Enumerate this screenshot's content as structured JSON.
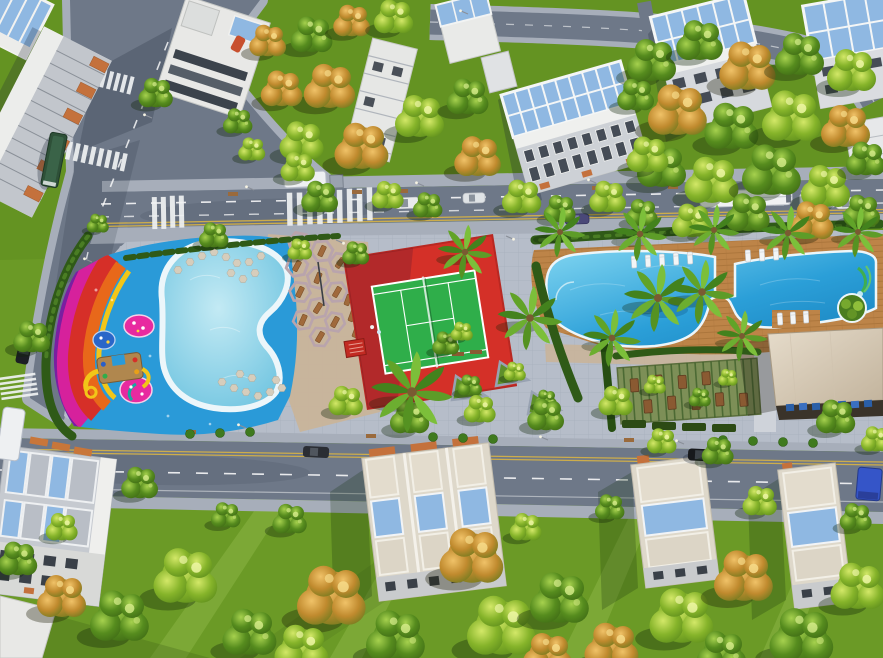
{
  "scene": {
    "description": "Aerial 3D architectural rendering of a residential community amenity strip at golden hour: a kids water playground with rainbow-striped deck and yellow slides, a kidney-shaped splash pool with stepping stones, hexagonal cabana seating, a red-apron tennis court with bright green surface, a large resort lagoon pool with timber deck, white sun loungers, palm islands and a green water slide, a beige clubhouse roof, a bamboo pergola terrace, tree-lined avenues with buses and cars, and white apartment buildings and townhouses with blue glass roofs among dense green and autumn-gold trees.",
    "lighting": "late afternoon sun from the east casting long shadows to the south-west",
    "landmarks": [
      "kids-water-playground",
      "rainbow-deck",
      "kids-pool",
      "playground-slides",
      "cabana-seating",
      "tennis-court",
      "main-pool",
      "pool-deck",
      "water-slide",
      "clubhouse",
      "pergola-terrace",
      "plaza-planters",
      "central-avenue",
      "bottom-street",
      "left-street",
      "top-street",
      "city-bus",
      "shuttle-buses",
      "cars",
      "apartment-buildings",
      "townhouses",
      "palm-trees",
      "street-trees"
    ]
  },
  "palette": {
    "lawn": "#6b9a26",
    "lawnDeep": "#4e7a18",
    "road": "#6e7888",
    "sidewalk": "#a7aeba",
    "paving": "#b6bdc9",
    "pavingWarm": "#c9b49a",
    "hedge": "#2f5a17",
    "water": "#2b9fd8",
    "waterDeep": "#1780bc",
    "splash": "#2a9ad8",
    "kidsWater": "#9fdcec",
    "poolRim": "#ecf6fa",
    "deckWood": "#bd8448",
    "courtRed": "#d43028",
    "courtGreen": "#2fae4a",
    "whiteLine": "#ffffff",
    "rbPurple": "#7a1fa0",
    "rbMagenta": "#d6219c",
    "rbRed": "#d62f28",
    "rbOrange": "#e8681a",
    "rbYellow": "#f2c618",
    "pinkIsland": "#e82aa0",
    "roofWhite": "#ecedeb",
    "glassBlue": "#8fb8e2",
    "facade": "#c9cdd3",
    "canopyOrange": "#c4713c",
    "clubRoof": "#ddd2c0",
    "pergola": "#7d8f57",
    "busGreen": "#2e5038",
    "slideYellow": "#f2c618",
    "benchOrange": "#c8763a",
    "chairBlue": "#2a5fa8"
  }
}
